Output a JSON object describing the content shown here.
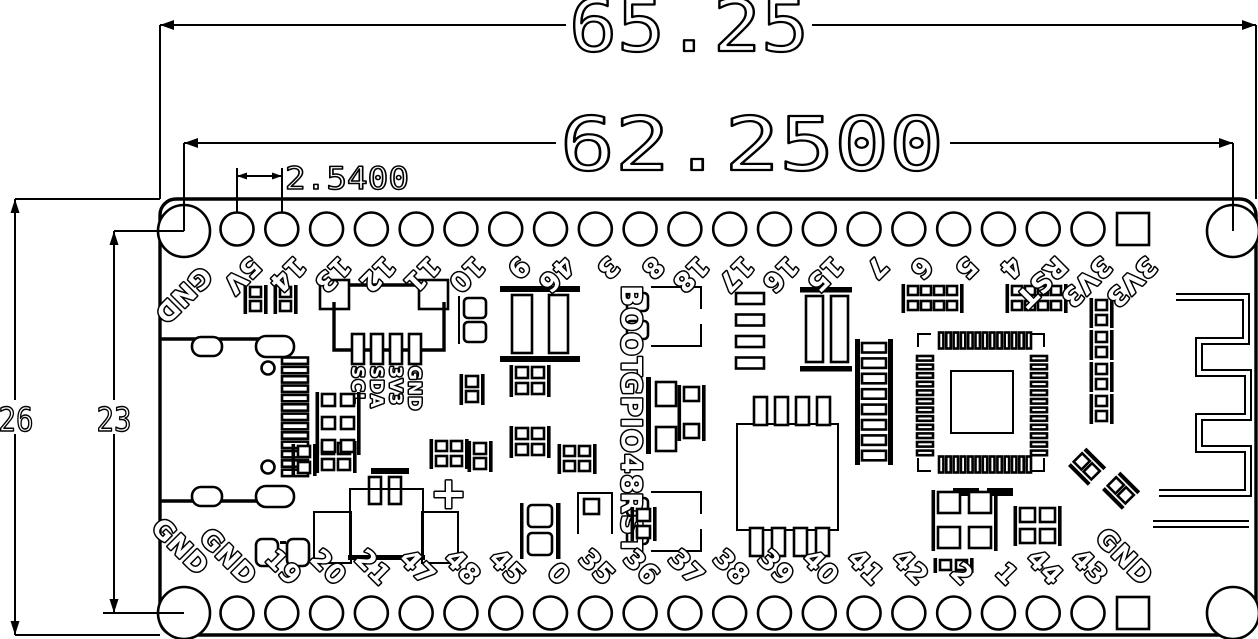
{
  "drawing": {
    "dimensions": {
      "overall_width": "65.25",
      "hole_pitch_width": "62.2500",
      "pin_pitch": "2.5400",
      "overall_height": "26",
      "hole_pitch_height": "23"
    },
    "pins": {
      "top_row": [
        "GND",
        "5V",
        "14",
        "13",
        "12",
        "11",
        "10",
        "9",
        "46",
        "3",
        "8",
        "18",
        "17",
        "16",
        "15",
        "7",
        "6",
        "5",
        "4",
        "RST",
        "3V3",
        "3V3"
      ],
      "bottom_row": [
        "GND",
        "GND",
        "19",
        "20",
        "21",
        "47",
        "48",
        "45",
        "0",
        "35",
        "36",
        "37",
        "38",
        "39",
        "40",
        "41",
        "42",
        "2",
        "1",
        "44",
        "43",
        "GND"
      ]
    },
    "silkscreen": {
      "boot_label": "BOOT",
      "gpio_label": "GPIO48",
      "reset_label": "RST",
      "io_header_labels": [
        "SCL",
        "SDA",
        "3V3",
        "GND"
      ],
      "battery_positive": "+"
    },
    "colors": {
      "ink": "#000000",
      "background": "#ffffff"
    }
  }
}
